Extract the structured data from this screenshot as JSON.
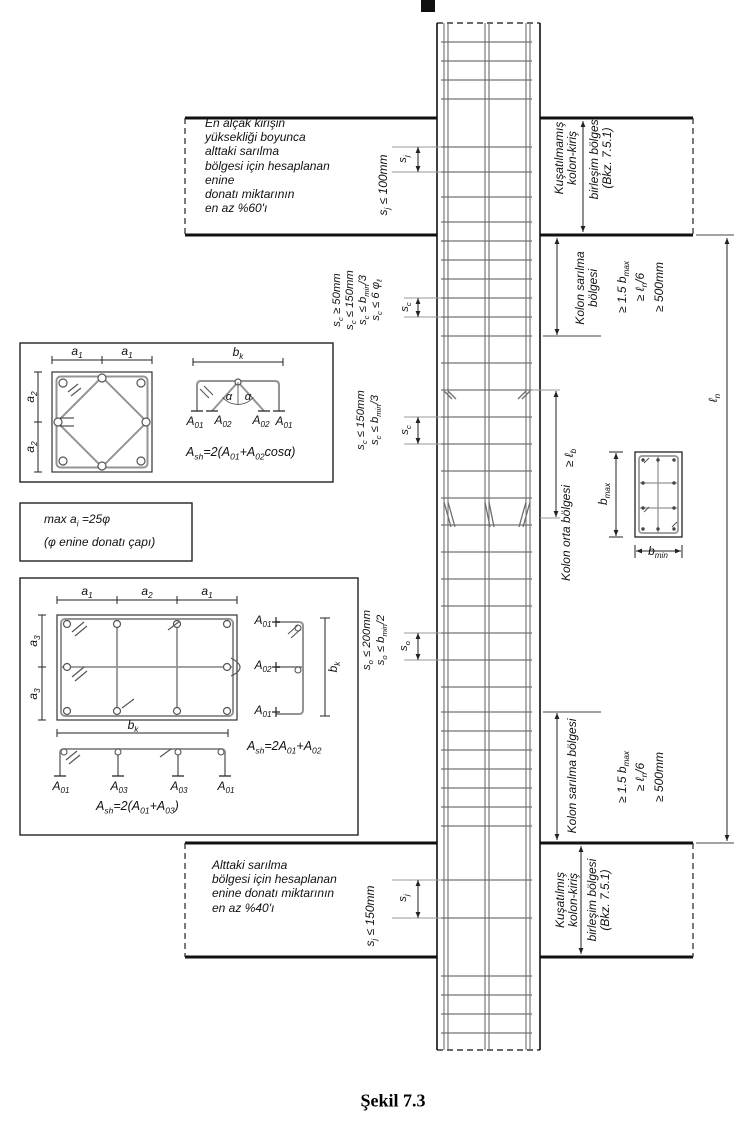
{
  "figure": {
    "caption": "Şekil 7.3"
  },
  "colors": {
    "ink": "#1a1a1a",
    "stirrup": "#a8a8a8",
    "rebar": "#6e6e6e",
    "hoop": "#949494"
  },
  "notes": {
    "top_left": "En alçak kirişin\nyüksekliği boyunca\nalttaki sarılma\nbölgesi için hesaplanan\nenine\ndonatı miktarının\nen az %60'ı",
    "bottom_left": "Alttaki sarılma\nbölgesi için hesaplanan\nenine donatı miktarının\nen az %40'ı"
  },
  "spacing": {
    "sj": "s_{j}",
    "sc": "s_{c}",
    "so": "s_{o}",
    "sj_top_rule": "s_{j} ≤ 100mm",
    "sj_bottom_rule": "s_{j} ≤ 150mm",
    "sc_top_rules": [
      "s_{c} ≥ 50mm",
      "s_{c} ≤ 150mm",
      "s_{c} ≤ b_{min}/3",
      "s_{c} ≤ 6 φ_{ℓ}"
    ],
    "sc_mid_rules": [
      "s_{c} ≤ 150mm",
      "s_{c} ≤ b_{min}/3"
    ],
    "so_rules": [
      "s_{o} ≤ 200mm",
      "s_{o} ≤ b_{min}/2"
    ]
  },
  "zones": {
    "joint_unconfined": [
      "Kuşatılmamış",
      "kolon-kiriş",
      "birleşim bölgesi",
      "(Bkz. 7.5.1)"
    ],
    "joint_confined": [
      "Kuşatılmış",
      "kolon-kiriş",
      "birleşim bölgesi",
      "(Bkz. 7.5.1)"
    ],
    "confinement_top": [
      "Kolon sarılma",
      "bölgesi"
    ],
    "confinement_bottom": "Kolon sarılma bölgesi",
    "confinement_rules": [
      "≥ 1.5 b_{max}",
      "≥ ℓ_{n}/6",
      "≥ 500mm"
    ],
    "middle": "Kolon orta bölgesi",
    "lap": "≥ ℓ_{b}",
    "ln": "ℓ_{n}"
  },
  "section_right": {
    "bmax": "b_{max}",
    "bmin": "b_{min}"
  },
  "detail_square": {
    "a1": "a_{1}",
    "a2": "a_{2}",
    "bk": "b_{k}",
    "alpha": "α",
    "legs": [
      "A_{01}",
      "A_{02}",
      "A_{02}",
      "A_{01}"
    ],
    "formula": "A_{sh}=2(A_{01}+A_{02}cosα)"
  },
  "note_box": {
    "line1": "max a_{i} =25φ",
    "line2": "(φ enine donatı çapı)"
  },
  "detail_rect": {
    "a1": "a_{1}",
    "a2": "a_{2}",
    "a3": "a_{3}",
    "bk": "b_{k}",
    "side_legs": [
      "A_{01}",
      "A_{02}",
      "A_{01}"
    ],
    "bottom_legs": [
      "A_{01}",
      "A_{03}",
      "A_{03}",
      "A_{01}"
    ],
    "formula_side": "A_{sh}=2A_{01}+A_{02}",
    "formula_bottom": "A_{sh}=2(A_{01}+A_{03})"
  }
}
